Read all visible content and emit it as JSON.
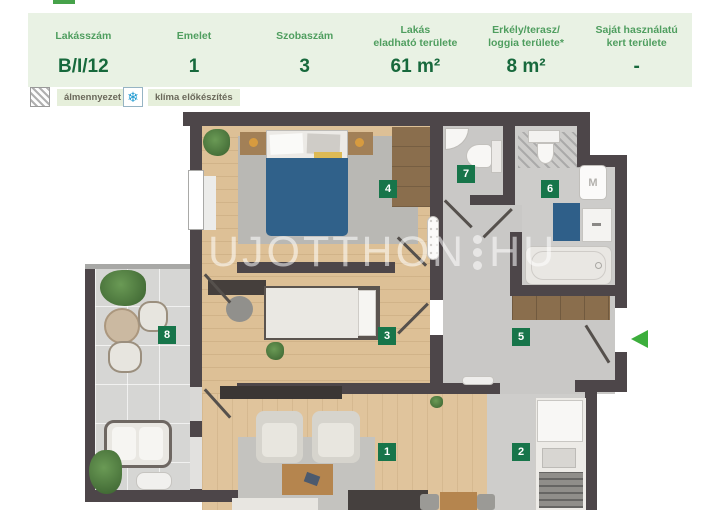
{
  "header": {
    "background": "#e9f2e4",
    "label_color": "#4f9e5f",
    "value_color": "#17693c",
    "columns": [
      {
        "line1": "Lakásszám",
        "line2": "",
        "value": "B/I/12"
      },
      {
        "line1": "Emelet",
        "line2": "",
        "value": "1"
      },
      {
        "line1": "Szobaszám",
        "line2": "",
        "value": "3"
      },
      {
        "line1": "Lakás",
        "line2": "eladható területe",
        "value": "61 m²"
      },
      {
        "line1": "Erkély/terasz/",
        "line2": "loggia területe*",
        "value": "8 m²"
      },
      {
        "line1": "Saját használatú",
        "line2": "kert területe",
        "value": "-"
      }
    ]
  },
  "legend": {
    "items": [
      {
        "icon": "hatch-icon",
        "label": "álmennyezet"
      },
      {
        "icon": "snowflake-icon",
        "label": "klíma előkészítés"
      }
    ],
    "snowflake_glyph": "❄",
    "snowflake_color": "#1f9ad1"
  },
  "floorplan": {
    "watermark": {
      "left": "UJOTTHON",
      "right": "HU"
    },
    "rooms": [
      {
        "number": "1"
      },
      {
        "number": "2"
      },
      {
        "number": "3"
      },
      {
        "number": "4"
      },
      {
        "number": "5"
      },
      {
        "number": "6"
      },
      {
        "number": "7"
      },
      {
        "number": "8"
      }
    ],
    "washer_label": "M",
    "badge_color": "#17754a",
    "entrance_arrow_color": "#3cae3c",
    "wall_color": "#4d4649"
  }
}
